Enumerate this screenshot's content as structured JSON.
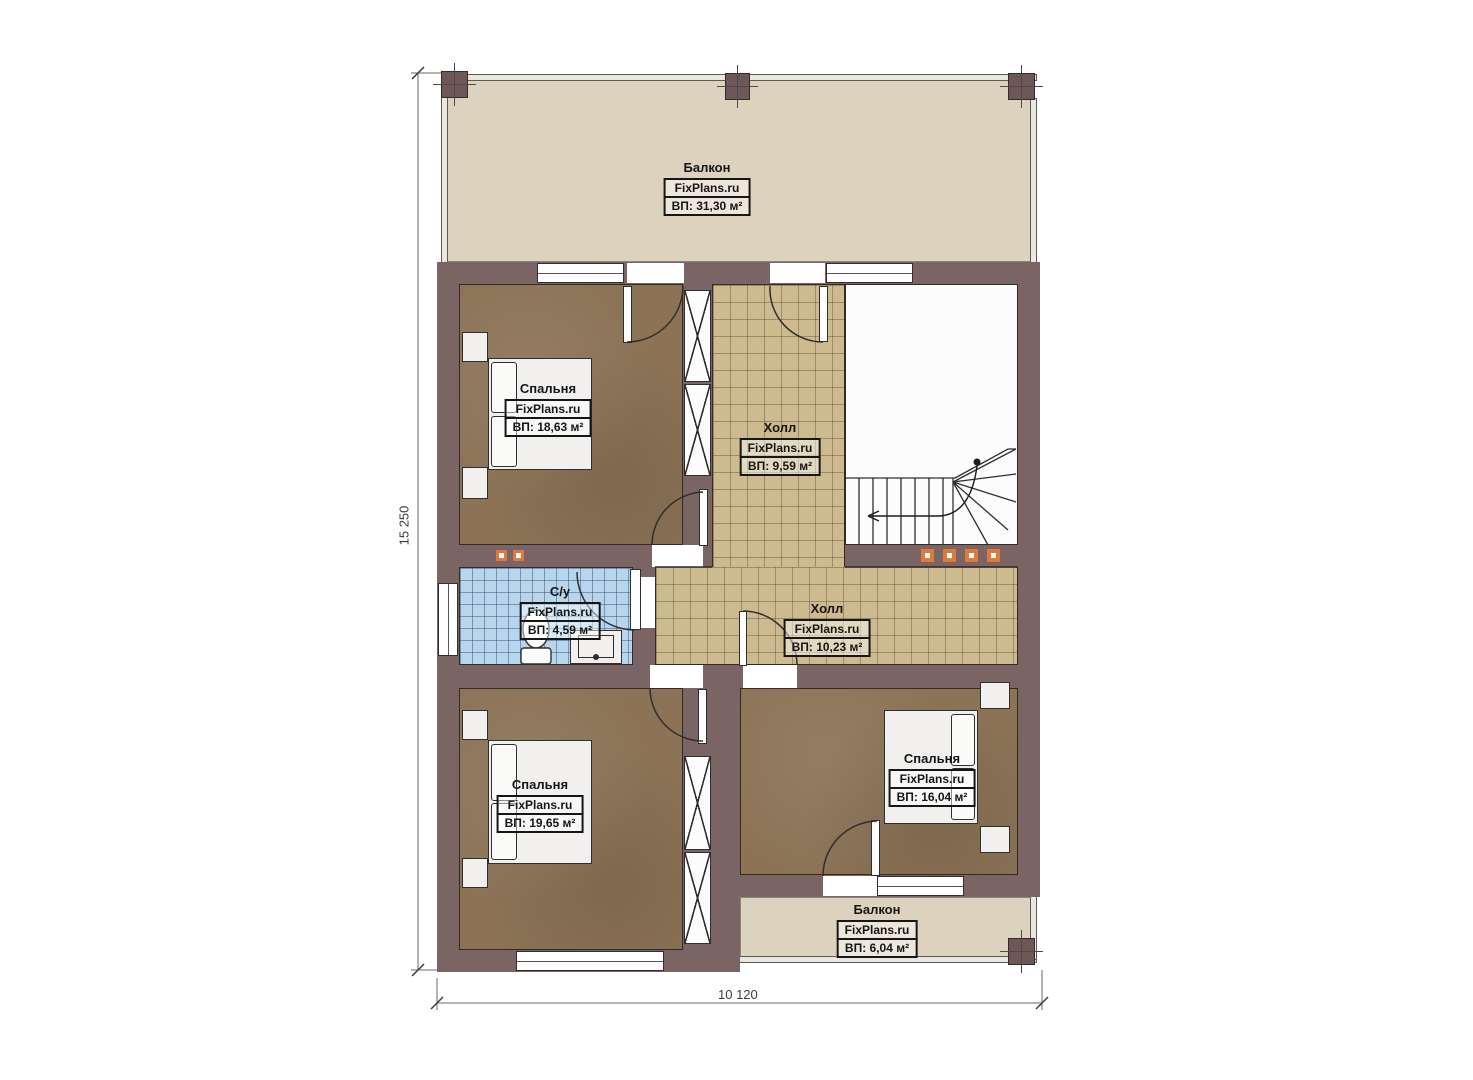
{
  "plan_title": "Floor plan (2nd floor)",
  "rooms": [
    {
      "name": "Балкон",
      "site": "FixPlans.ru",
      "area": "ВП: 31,30 м²"
    },
    {
      "name": "Спальня",
      "site": "FixPlans.ru",
      "area": "ВП: 18,63 м²"
    },
    {
      "name": "Холл",
      "site": "FixPlans.ru",
      "area": "ВП: 9,59 м²"
    },
    {
      "name": "С/у",
      "site": "FixPlans.ru",
      "area": "ВП: 4,59 м²"
    },
    {
      "name": "Холл",
      "site": "FixPlans.ru",
      "area": "ВП: 10,23 м²"
    },
    {
      "name": "Спальня",
      "site": "FixPlans.ru",
      "area": "ВП: 19,65 м²"
    },
    {
      "name": "Спальня",
      "site": "FixPlans.ru",
      "area": "ВП: 16,04 м²"
    },
    {
      "name": "Балкон",
      "site": "FixPlans.ru",
      "area": "ВП: 6,04 м²"
    }
  ],
  "dimensions": {
    "height": "15 250",
    "width": "10 120"
  },
  "colors": {
    "wall": "#7b6464",
    "floor_bedroom": "#8c7356",
    "floor_hall": "#cdbb8f",
    "floor_bath": "#b9d5eb",
    "floor_balcony": "#dcd2bd",
    "marker": "#dd7a3c",
    "outline": "#332a24"
  }
}
